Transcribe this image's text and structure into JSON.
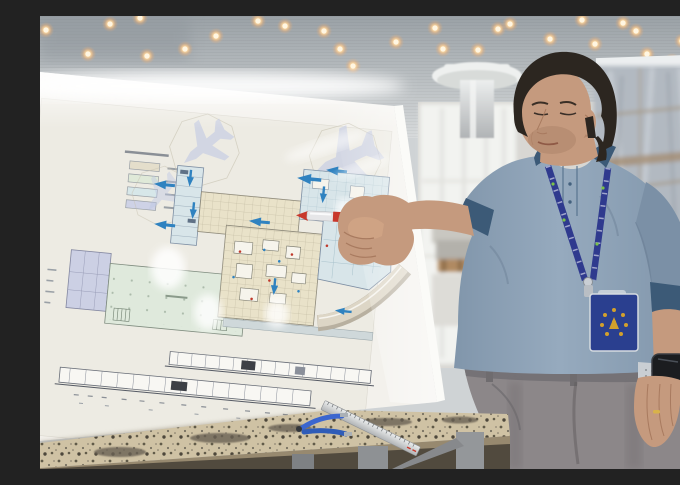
{
  "meta": {
    "description": "Engineer in a heather-blue polo shirt pointing with a red pen at a large airport terminal floor-plan board, inside a terminal hall under construction with a perforated ceiling of warm downlights, plastic sheeting, steel profiles and a workbench covered in metal shavings",
    "width_px": 680,
    "height_px": 453
  },
  "scene": {
    "ceiling": {
      "type": "perforated metal grid ceiling",
      "downlight_count": 29
    },
    "board": {
      "type": "glossy white board with printed terminal floor plan",
      "legend_swatch_count": 4,
      "airplane_silhouette_count": 3,
      "has_elevation_strip": true
    },
    "person": {
      "pose": "pointing at plan with red pen",
      "shirt": "heather blue polo with navy collar and cuffs",
      "accessories": [
        "navy lanyard with badge",
        "smartwatch",
        "gold ring"
      ]
    },
    "foreground": {
      "items": [
        "workbench with metal shavings",
        "aluminum ruler",
        "blue-handled tool"
      ]
    },
    "background": {
      "items": [
        "plastic sheeting",
        "white mushroom column",
        "steel beams",
        "aluminum profiles",
        "construction materials"
      ]
    }
  },
  "palette": {
    "ceiling_top": "#9aa1a6",
    "ceiling_bottom": "#d7dadb",
    "board_face": "#f3f1ec",
    "plan_paper": "#edebe3",
    "legend_1": "#e4decb",
    "legend_2": "#dfe9d8",
    "legend_3": "#d7e7e9",
    "legend_4": "#ced2e6",
    "plan_beige": "#e9e2c9",
    "plan_green": "#dfe9dc",
    "plan_blue": "#d8e5e9",
    "plan_purple": "#ccd0e4",
    "plan_line": "#8b8fa0",
    "arrow_blue": "#2f82c0",
    "road_tan": "#ddd6c6",
    "pen_red": "#c8382c",
    "pen_silver": "#e6e6e8",
    "skin": "#c59a7e",
    "skin_shadow": "#a87a5f",
    "hair": "#2c2620",
    "polo_main": "#8196ab",
    "polo_light": "#96aabe",
    "polo_trim": "#3c5a77",
    "lanyard": "#2f3a8e",
    "badge_navy": "#2a3f8f",
    "badge_gold": "#d3a02c",
    "trousers": "#8c8789",
    "watch_band": "#c9ced3",
    "watch_face": "#1b1d20",
    "table_top": "#cfc2a4",
    "table_edge": "#97896f",
    "debris_dark": "#4f483c",
    "ruler_metal": "#d7d9da",
    "tool_blue": "#3b66cf",
    "sheeting": "#b2b9c1",
    "window_bright": "#f2f3f0",
    "column_white": "#eef0ef",
    "floor": "#c8c5bf",
    "beam_dark": "#5f6367",
    "beam_light": "#d2d5d7",
    "wood": "#b08a62",
    "debris_yellow": "#c59f3e"
  }
}
